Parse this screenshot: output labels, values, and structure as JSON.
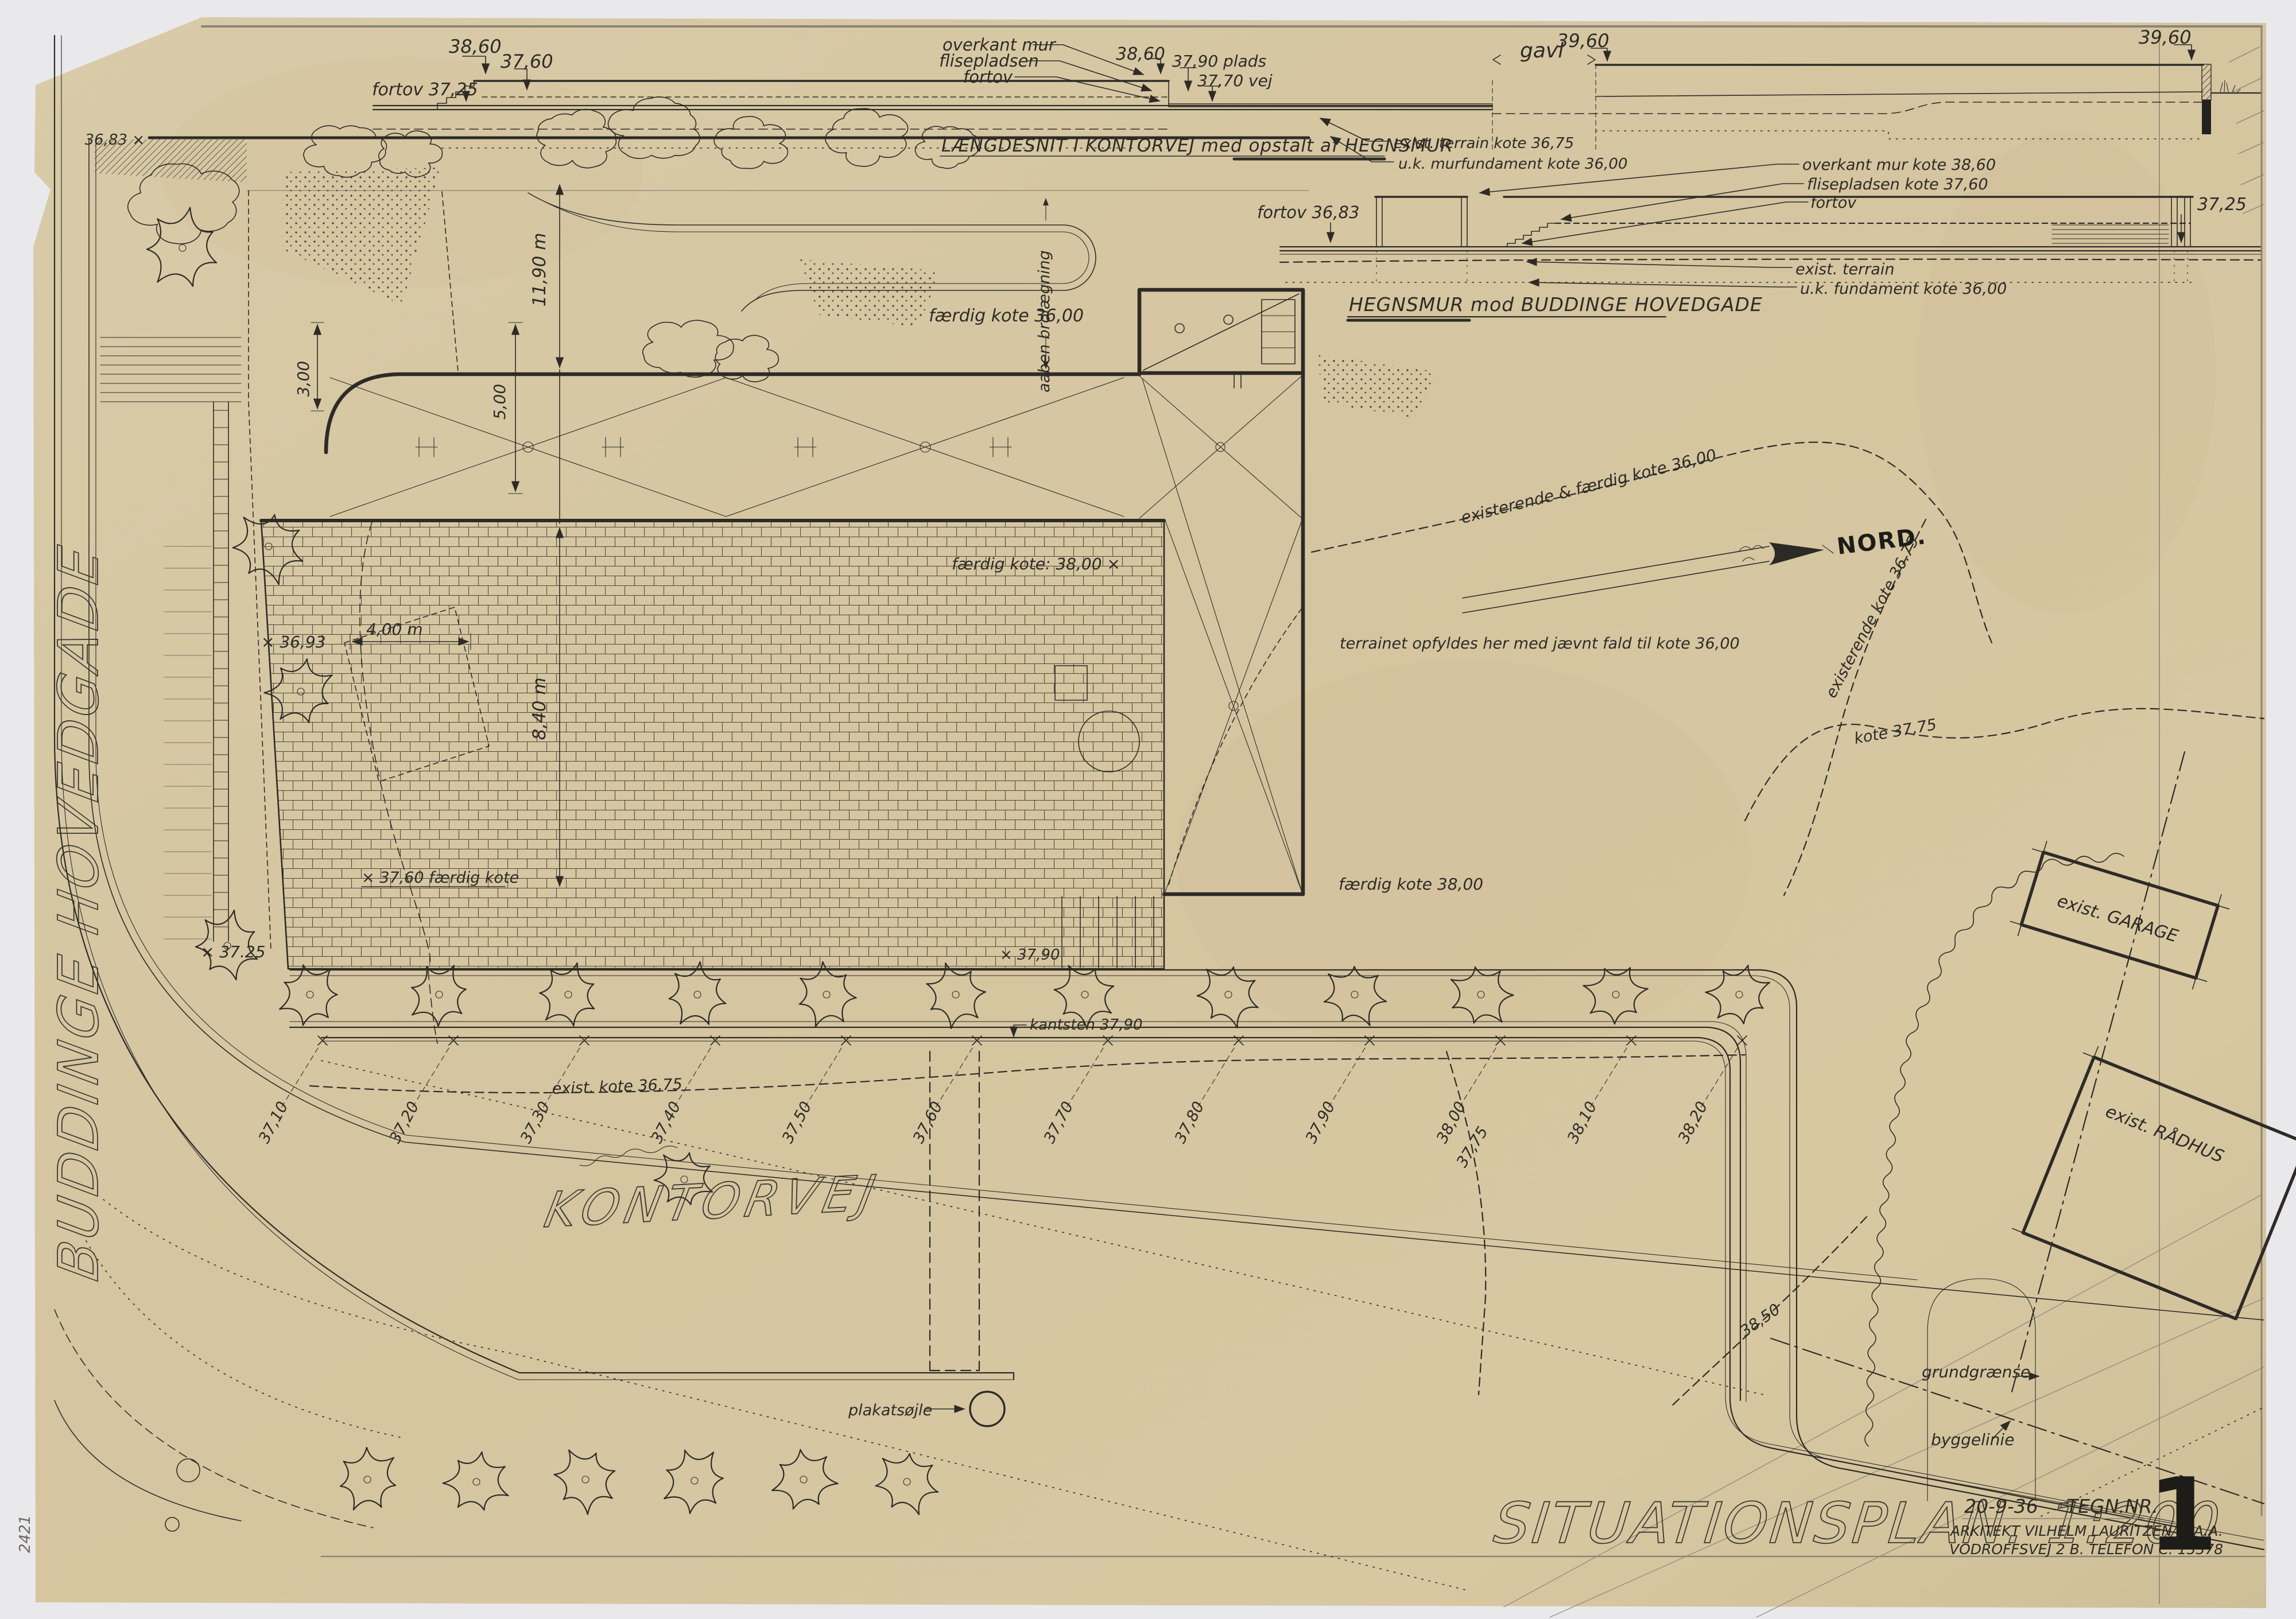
{
  "colors": {
    "paper": "#d6c7a2",
    "ink": "#2e2b26",
    "pencil": "#8d8476"
  },
  "title_block": {
    "plan_title": "SITUATIONSPLAN. 1:200",
    "date": "20-9-36",
    "tegn_nr": "TEGN.NR.",
    "architect": "ARKITEKT VILHELM LAURITZEN M.A.A.",
    "address": "VODROFFSVEJ 2 B. TELEFON C. 13378",
    "sheet_number": "1",
    "archive_number": "2421"
  },
  "section_laengdesnit": {
    "title": "LÆNGDESNIT I KONTORVEJ med opstalt af HEGNSMUR",
    "fortov_level": "fortov 37,25",
    "top_38_60": "38,60",
    "top_37_60": "37,60",
    "overkant_mur": "overkant mur",
    "flisepladsen": "flisepladsen",
    "fortov": "fortov",
    "right_38_60": "38,60",
    "plads_37_90": "37,90 plads",
    "vej_37_70": "37,70 vej",
    "gavl": "gavl",
    "kote_39_60_a": "39,60",
    "kote_39_60_b": "39,60",
    "exist_terrain": "exist. terrain kote 36,75",
    "uk_murfundament": "u.k. murfundament kote 36,00"
  },
  "section_hegnsmur": {
    "title": "HEGNSMUR mod BUDDINGE HOVEDGADE",
    "fortov_36_83": "fortov 36,83",
    "overkant_mur": "overkant mur kote 38,60",
    "flisepladsen": "flisepladsen kote 37,60",
    "fortov": "fortov",
    "exist_terrain": "exist. terrain",
    "uk_fundament": "u.k. fundament kote 36,00",
    "kote_37_25": "37,25"
  },
  "plan": {
    "street_kontorvej": "KONTORVEJ",
    "street_buddinge": "BUDDINGE HOVEDGADE",
    "nord": "NORD.",
    "spot_36_83": "36,83 ×",
    "spot_36_93": "× 36,93",
    "spot_37_25": "× 37.25",
    "spot_37_90": "× 37,90",
    "dim_3_00": "3,00",
    "dim_5_00": "5,00",
    "dim_11_90": "11,90 m",
    "dim_8_40": "8,40 m",
    "dim_4_00": "4,00 m",
    "aaben_brolaegning": "aaben brolægning",
    "faerdig_36": "færdig kote 36,00",
    "faerdig_38_plaza": "færdig kote: 38,00 ×",
    "faerdig_37_60": "× 37,60 færdig kote",
    "faerdig_38_right": "færdig kote 38,00",
    "terrain_note": "terrainet opfyldes her med jævnt fald til kote 36,00",
    "contour_36_00": "existerende & færdig kote 36,00",
    "contour_36_75_ne": "existerende kote 36.75",
    "contour_37_75": "kote 37,75",
    "kantsten": "kantsten 37,90",
    "exist_kote_36_75": "exist. kote 36,75",
    "street_spot_levels": [
      "37,10",
      "37,20",
      "37,30",
      "37,40",
      "37,50",
      "37,60",
      "37,70",
      "37,80",
      "37,90",
      "38,00",
      "38,10",
      "38,20"
    ],
    "spot_37_75_street": "37,75",
    "spot_38_50": "38,50",
    "plakatsojle": "plakatsøjle",
    "grundgraense": "grundgrænse",
    "byggelinie": "byggelinie",
    "exist_garage": "exist. GARAGE",
    "exist_raadhus": "exist. RÅDHUS"
  }
}
